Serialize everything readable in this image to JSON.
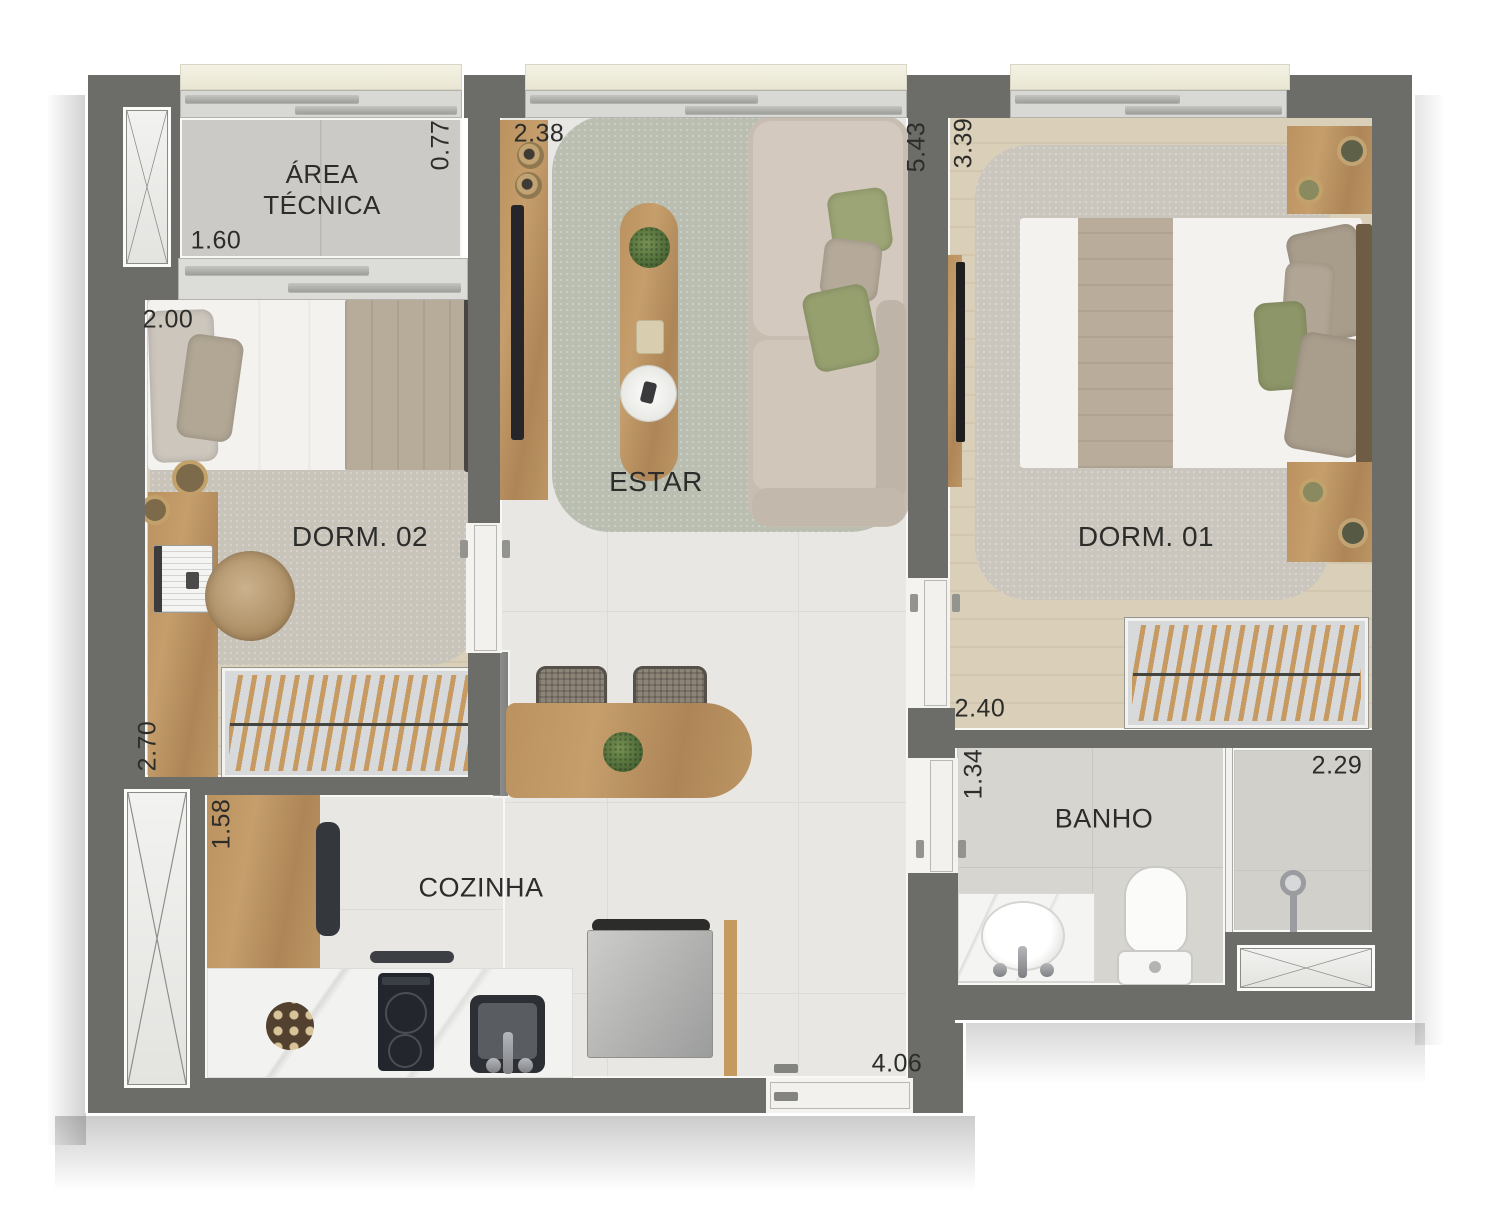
{
  "plan_type": "apartment-floor-plan",
  "rooms": {
    "area_tecnica": {
      "name_line1": "ÁREA",
      "name_line2": "TÉCNICA",
      "width_m": "1.60",
      "depth_m": "0.77"
    },
    "dorm02": {
      "name": "DORM. 02",
      "width_m": "2.00",
      "depth_m": "2.70"
    },
    "estar": {
      "name": "ESTAR",
      "width_m": "2.38",
      "depth_m": "5.43"
    },
    "dorm01": {
      "name": "DORM. 01",
      "width_m": "2.40",
      "depth_m": "3.39"
    },
    "cozinha": {
      "name": "COZINHA",
      "width_m": "4.06",
      "depth_m": "1.58"
    },
    "banho": {
      "name": "BANHO",
      "width_m": "2.29",
      "depth_m": "1.34"
    }
  },
  "colors": {
    "wall": "#6c6c69",
    "keyline": "#f8f8f6",
    "tile_floor": "#e8e7e3",
    "wood_floor": "#dacfb9",
    "rug_estar": "#b9beb1",
    "rug_dorm": "#c9c5bc",
    "furniture_wood": "#bb925f",
    "pillow_olive": "#96a06f",
    "pillow_taupe": "#b2a695",
    "label_text": "#2c2c2a"
  }
}
